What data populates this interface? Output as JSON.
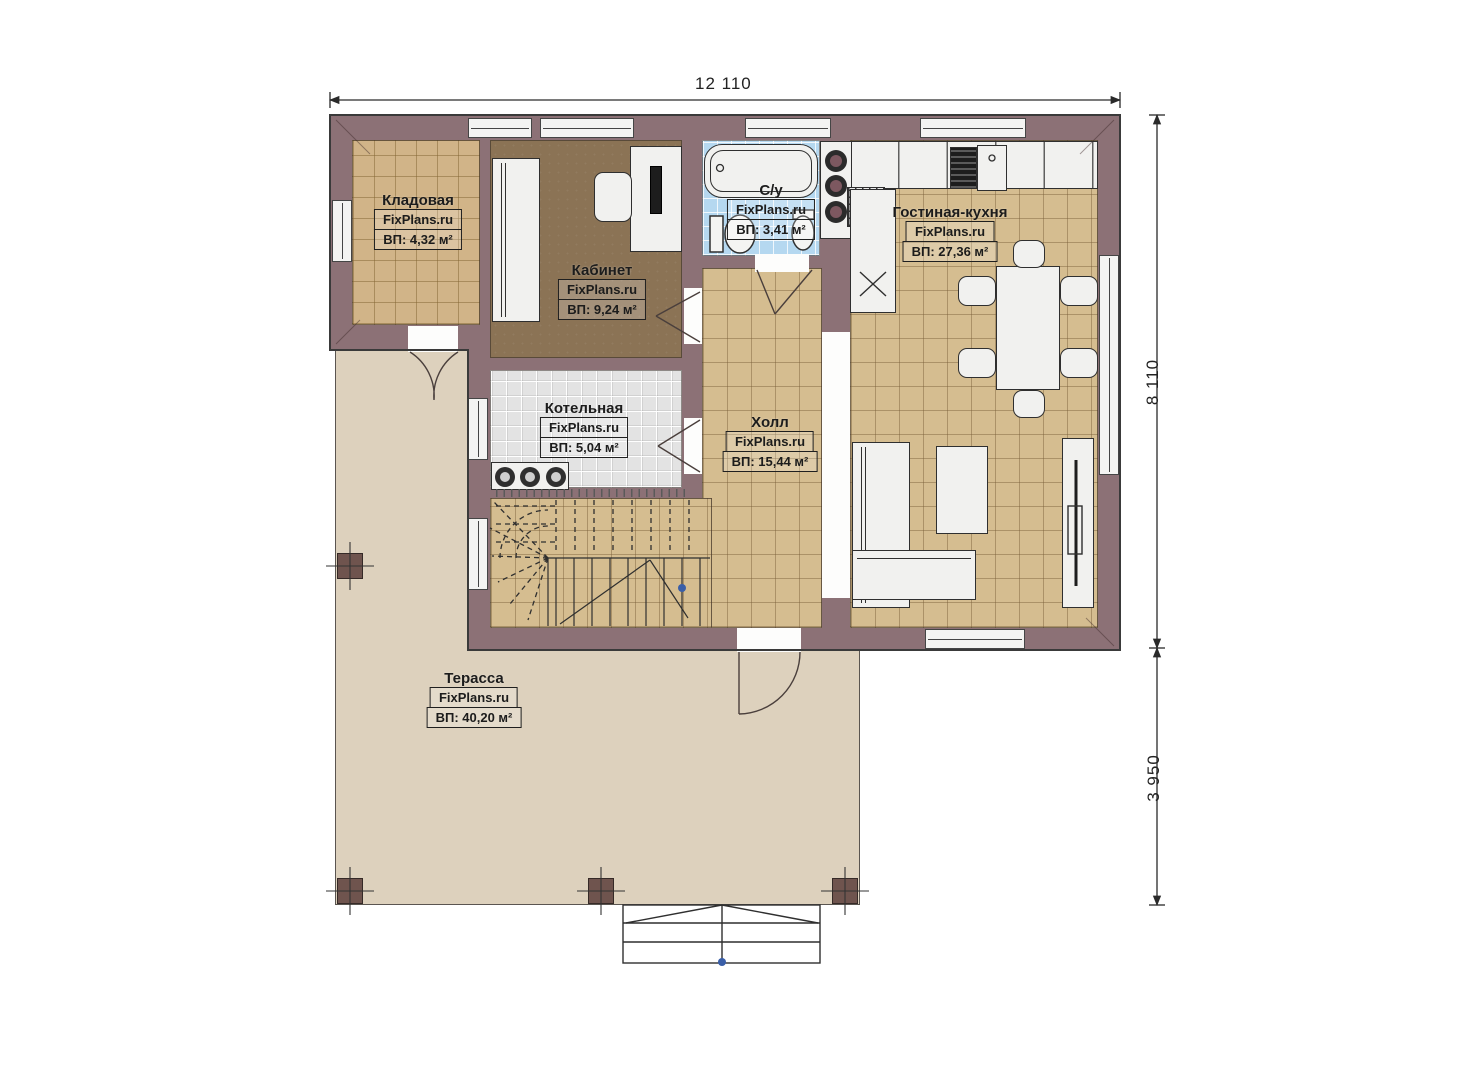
{
  "plan_title": "First floor plan",
  "dimensions": {
    "width_top": "12 110",
    "height_right": "8 110",
    "terrace_right": "3 950"
  },
  "rooms": [
    {
      "id": "kladovaya",
      "name": "Кладовая",
      "brand": "FixPlans.ru",
      "area": "ВП: 4,32 м²"
    },
    {
      "id": "kabinet",
      "name": "Кабинет",
      "brand": "FixPlans.ru",
      "area": "ВП: 9,24 м²"
    },
    {
      "id": "su",
      "name": "С/у",
      "brand": "FixPlans.ru",
      "area": "ВП: 3,41 м²"
    },
    {
      "id": "gostinaya",
      "name": "Гостиная-кухня",
      "brand": "FixPlans.ru",
      "area": "ВП: 27,36 м²"
    },
    {
      "id": "kotelnaya",
      "name": "Котельная",
      "brand": "FixPlans.ru",
      "area": "ВП: 5,04 м²"
    },
    {
      "id": "holl",
      "name": "Холл",
      "brand": "FixPlans.ru",
      "area": "ВП: 15,44 м²"
    },
    {
      "id": "terassa",
      "name": "Терасса",
      "brand": "FixPlans.ru",
      "area": "ВП: 40,20 м²"
    }
  ],
  "colors": {
    "wall": "#8c7176",
    "floor_tan": "#d1b488",
    "floor_beige": "#d5bd90",
    "floor_brown": "#8b7355",
    "floor_blue": "#b5d8f0",
    "floor_gray": "#e3e3e3",
    "terrace": "#ddd1bd",
    "walk_dot": "#3a5fa8"
  }
}
